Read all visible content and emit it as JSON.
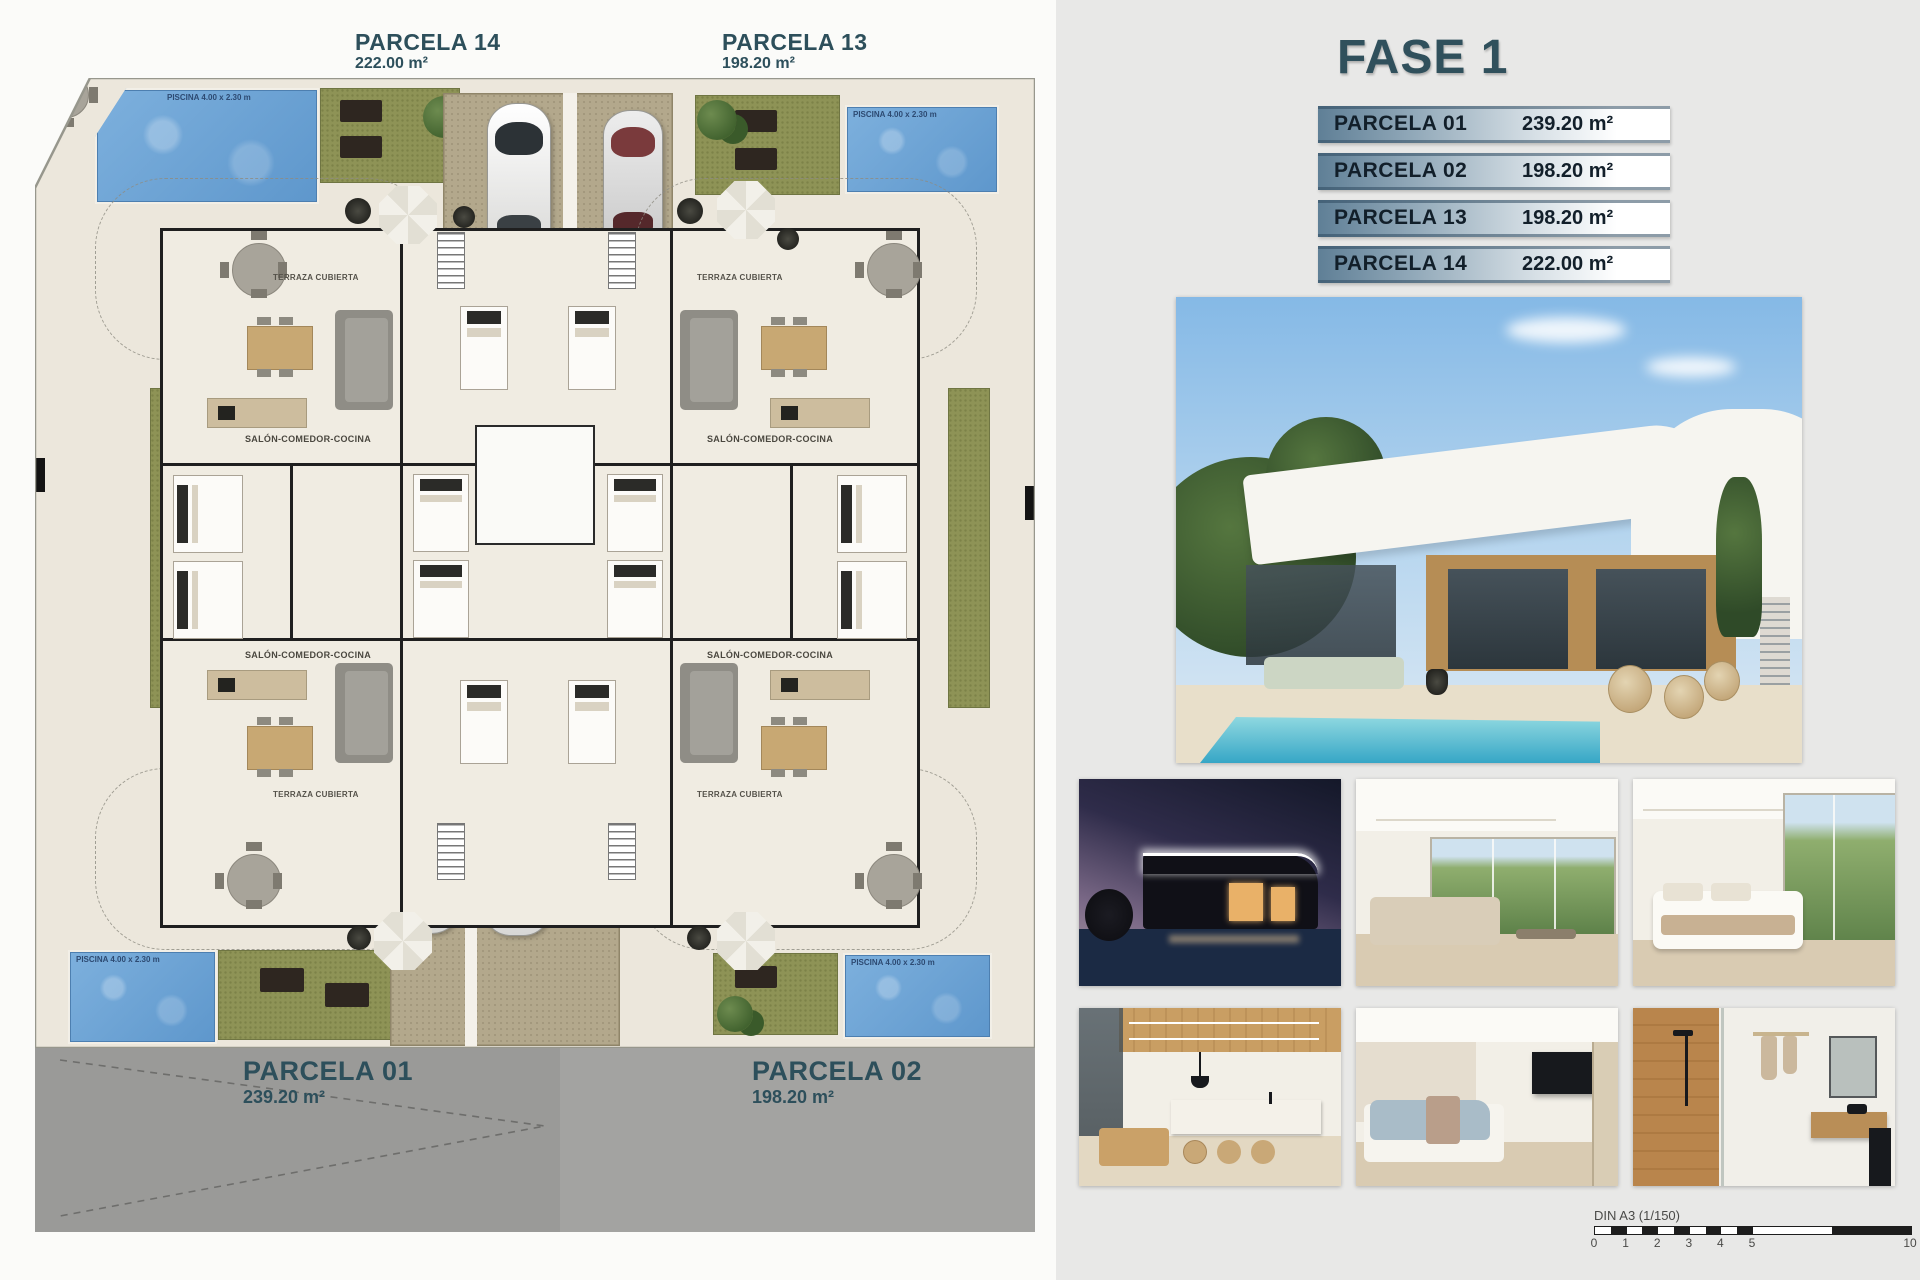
{
  "plan": {
    "p14": {
      "name": "PARCELA 14",
      "area": "222.00 m²"
    },
    "p13": {
      "name": "PARCELA 13",
      "area": "198.20 m²"
    },
    "p01": {
      "name": "PARCELA 01",
      "area": "239.20 m²"
    },
    "p02": {
      "name": "PARCELA 02",
      "area": "198.20 m²"
    },
    "labels": {
      "terrace": "TERRAZA CUBIERTA",
      "living": "SALÓN-COMEDOR-COCINA",
      "piscina": "PISCINA 4.00 x 2.30 m"
    }
  },
  "panel": {
    "title": "FASE 1",
    "table": {
      "rows": [
        {
          "label": "PARCELA 01",
          "area": "239.20 m²"
        },
        {
          "label": "PARCELA 02",
          "area": "198.20 m²"
        },
        {
          "label": "PARCELA 13",
          "area": "198.20 m²"
        },
        {
          "label": "PARCELA 14",
          "area": "222.00 m²"
        }
      ]
    },
    "photos": {
      "hero": "exterior-villa-pool-render",
      "thumbnails": [
        "night-exterior",
        "living-room",
        "bedroom-terrace",
        "kitchen-dining",
        "bedroom-tv",
        "bathroom"
      ]
    },
    "scalebar": {
      "label": "DIN A3 (1/150)",
      "ticks": [
        "0",
        "1",
        "2",
        "3",
        "4",
        "5",
        "10"
      ]
    }
  },
  "colors": {
    "accent_teal": "#30505c",
    "row_text": "#121f2a",
    "pool_blue": "#6ba3d6",
    "grass_olive": "#8e9356",
    "driveway_khaki": "#b3a88c",
    "road_gray": "#a3a3a1",
    "plan_ground": "#ece7dc"
  }
}
